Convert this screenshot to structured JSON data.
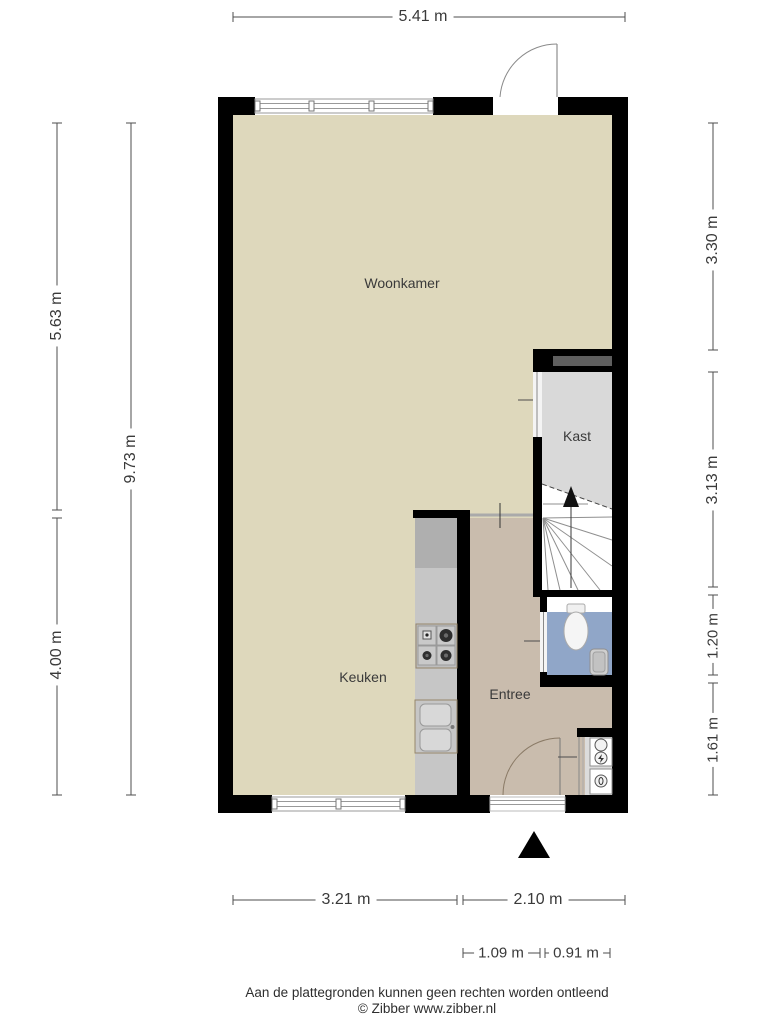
{
  "rooms": {
    "woonkamer": "Woonkamer",
    "kast": "Kast",
    "keuken": "Keuken",
    "entree": "Entree"
  },
  "dimensions": {
    "top_width": "5.41 m",
    "left_upper": "5.63 m",
    "left_lower": "4.00 m",
    "left_total": "9.73 m",
    "right_top": "3.30 m",
    "right_middle": "3.13 m",
    "right_toilet": "1.20 m",
    "right_bottom": "1.61 m",
    "bottom_left": "3.21 m",
    "bottom_right": "2.10 m",
    "bottom_inner_left": "1.09 m",
    "bottom_inner_right": "0.91 m"
  },
  "footer": {
    "disclaimer": "Aan de plattegronden kunnen geen rechten worden ontleend",
    "copyright": "© Zibber www.zibber.nl"
  },
  "colors": {
    "wall": "#000000",
    "floor_main": "#ded8bc",
    "floor_entree": "#c9bcad",
    "floor_kast": "#d9d9d9",
    "floor_toilet": "#90a6c8",
    "counter": "#c6c6c6",
    "counter_dark": "#afafaf",
    "dim_line": "#4d4d4d",
    "label_text": "#3a3a3a"
  }
}
